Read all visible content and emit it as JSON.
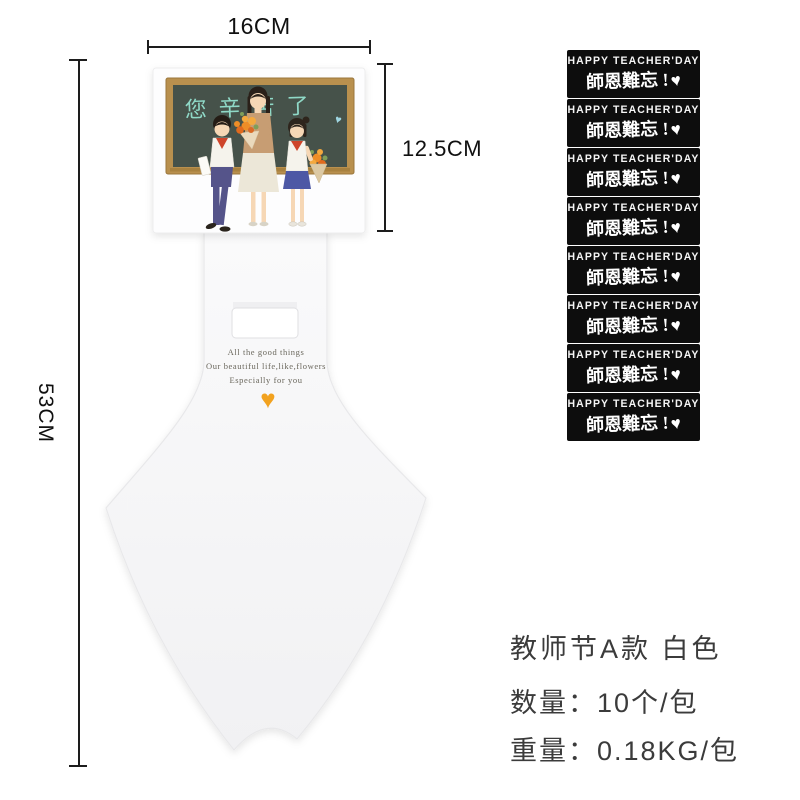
{
  "dimensions": {
    "width": "16CM",
    "card_height": "12.5CM",
    "total_height": "53CM"
  },
  "holder_card": {
    "blackboard_text": "您辛苦了",
    "message_line1": "All the good things",
    "message_line2": "Our beautiful life,like,flowers",
    "message_line3": "Especially for you"
  },
  "stickers": {
    "items": [
      {
        "line1": "HAPPY TEACHER'DAY",
        "line2": "師恩難忘 !"
      },
      {
        "line1": "HAPPY TEACHER'DAY",
        "line2": "師恩難忘 !"
      },
      {
        "line1": "HAPPY TEACHER'DAY",
        "line2": "師恩難忘 !"
      },
      {
        "line1": "HAPPY TEACHER'DAY",
        "line2": "師恩難忘 !"
      },
      {
        "line1": "HAPPY TEACHER'DAY",
        "line2": "師恩難忘 !"
      },
      {
        "line1": "HAPPY TEACHER'DAY",
        "line2": "師恩難忘 !"
      },
      {
        "line1": "HAPPY TEACHER'DAY",
        "line2": "師恩難忘 !"
      },
      {
        "line1": "HAPPY TEACHER'DAY",
        "line2": "師恩難忘 !"
      }
    ]
  },
  "product_info": {
    "title": "教师节A款  白色",
    "quantity": "数量：10个/包",
    "weight": "重量：0.18KG/包"
  },
  "icons": {
    "heart": "♥"
  },
  "colors": {
    "accent_heart": "#f2a21f",
    "sticker_bg": "#0d0d0d",
    "chalk_text": "#8fd9c7",
    "blackboard": "#46524a",
    "board_frame": "#b9904e",
    "dimension_lines": "#1d1d1d",
    "info_text": "#3b3b3b"
  }
}
